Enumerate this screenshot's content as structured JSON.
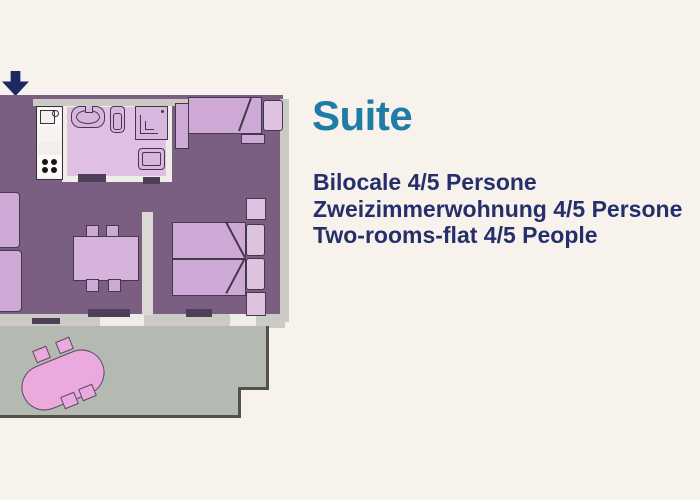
{
  "text": {
    "title": "Suite",
    "captions": [
      "Bilocale 4/5 Persone",
      "Zweizimmerwohnung 4/5 Persone",
      "Two-rooms-flat 4/5 People"
    ]
  },
  "colors": {
    "background": "#f7f3ec",
    "title_accent": "#1f7ca6",
    "caption_text": "#252f6b",
    "entrance_arrow": "#1d2a61",
    "room_floor_purple": "#7b5f82",
    "bathroom_floor": "#dfc0e2",
    "furniture_light_purple": "#cfa9d6",
    "furniture_pale_purple": "#ddc3e0",
    "wall_gray": "#cbcac5",
    "wall_white": "#efede8",
    "terrace_floor": "#b4b9b1",
    "terrace_edge": "#53514b",
    "terrace_table_pink": "#eaaade",
    "fixture_outline": "#44394c"
  },
  "floorplan": {
    "description": "two-room suite floor plan",
    "elements": [
      "entrance-arrow-icon",
      "kitchen-sink-icon",
      "stove-icon",
      "bath-sink-icon",
      "toilet-icon",
      "shower-icon",
      "bidet-icon",
      "single-bed",
      "double-bed",
      "pillow",
      "nightstand",
      "dining-table",
      "chair",
      "sofa",
      "terrace-table"
    ]
  }
}
